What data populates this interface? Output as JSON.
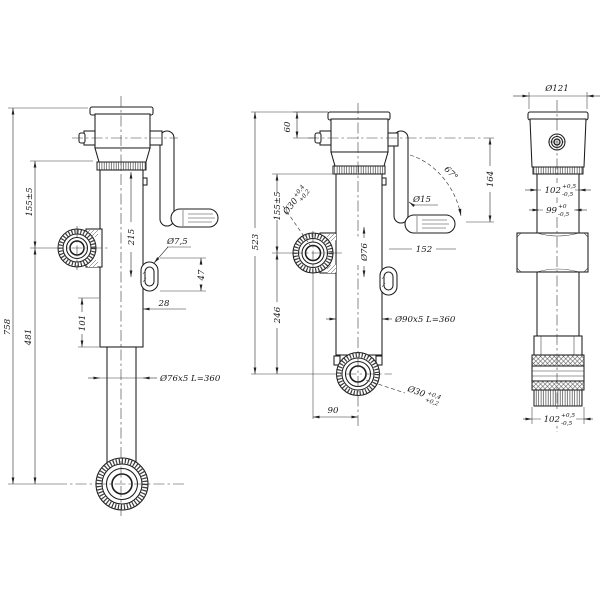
{
  "colors": {
    "line": "#1c1c1c",
    "background": "#ffffff"
  },
  "views": {
    "left": {
      "dims": {
        "overall_height": "758",
        "pivot_to_base": "481",
        "top_to_pivot": "155±5",
        "tube_length": "215",
        "inner_offset": "101",
        "hole_dia": "Ø7,5",
        "slot_length": "47",
        "slot_offset": "28",
        "tube_spec": "Ø76x5 L=360"
      }
    },
    "middle": {
      "dims": {
        "cap_height": "60",
        "overall": "523",
        "top_to_pivot": "155±5",
        "pivot_to_eye": "246",
        "inner_tube_dia": "Ø76",
        "crank_dia": "Ø15",
        "crank_angle": "67°",
        "crank_height": "164",
        "crank_reach": "152",
        "tube_spec": "Ø90x5 L=360",
        "eye_offset": "90",
        "pivot_bore": "Ø30",
        "pivot_bore_plus": "+0,4",
        "pivot_bore_minus": "+0,2",
        "eye_bore": "Ø30",
        "eye_bore_plus": "+0,4",
        "eye_bore_minus": "+0,2"
      }
    },
    "right": {
      "dims": {
        "cap_dia": "Ø121",
        "width_upper": "102",
        "width_upper_plus": "+0,5",
        "width_upper_minus": "-0,5",
        "width_inner": "99",
        "width_inner_plus": "+0",
        "width_inner_minus": "-0,5",
        "width_lower": "102",
        "width_lower_plus": "+0,5",
        "width_lower_minus": "-0,5"
      }
    }
  }
}
